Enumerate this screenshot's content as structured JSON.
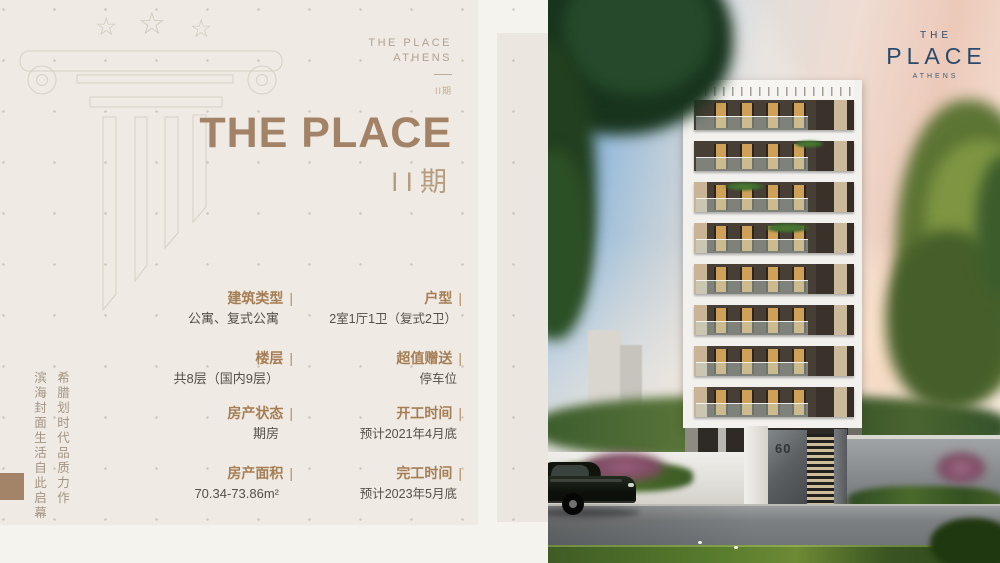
{
  "colors": {
    "page_background": "#f5f3ee",
    "panel_background": "#efebe4",
    "inset_panel": "#ebe7e0",
    "accent_brown": "#a28367",
    "label_brown": "#a57e55",
    "value_gray": "#55504a",
    "outline_taupe": "#d7d0c3",
    "logo_navy": "#2b4a6b"
  },
  "left_panel": {
    "stars": [
      "☆",
      "☆",
      "☆"
    ],
    "mini_logo": {
      "line1": "THE PLACE",
      "line2": "ATHENS",
      "phase": "II期"
    },
    "title": "THE PLACE",
    "phase": "II期",
    "vertical_slogan": {
      "line1": "希腊划时代品质力作",
      "line2": "滨海封面生活自此启幕"
    },
    "details": {
      "divider": "|",
      "items": [
        {
          "label": "建筑类型",
          "value": "公寓、复式公寓"
        },
        {
          "label": "户型",
          "value": "2室1厅1卫（复式2卫）"
        },
        {
          "label": "楼层",
          "value": "共8层（国内9层）"
        },
        {
          "label": "超值赠送",
          "value": "停车位"
        },
        {
          "label": "房产状态",
          "value": "期房"
        },
        {
          "label": "开工时间",
          "value": "预计2021年4月底"
        },
        {
          "label": "房产面积",
          "value": "70.34-73.86m²"
        },
        {
          "label": "完工时间",
          "value": "预计2023年5月底"
        }
      ]
    }
  },
  "photo": {
    "logo": {
      "the": "THE",
      "place": "PLACE",
      "athens": "ATHENS"
    },
    "gate_number": "60"
  }
}
